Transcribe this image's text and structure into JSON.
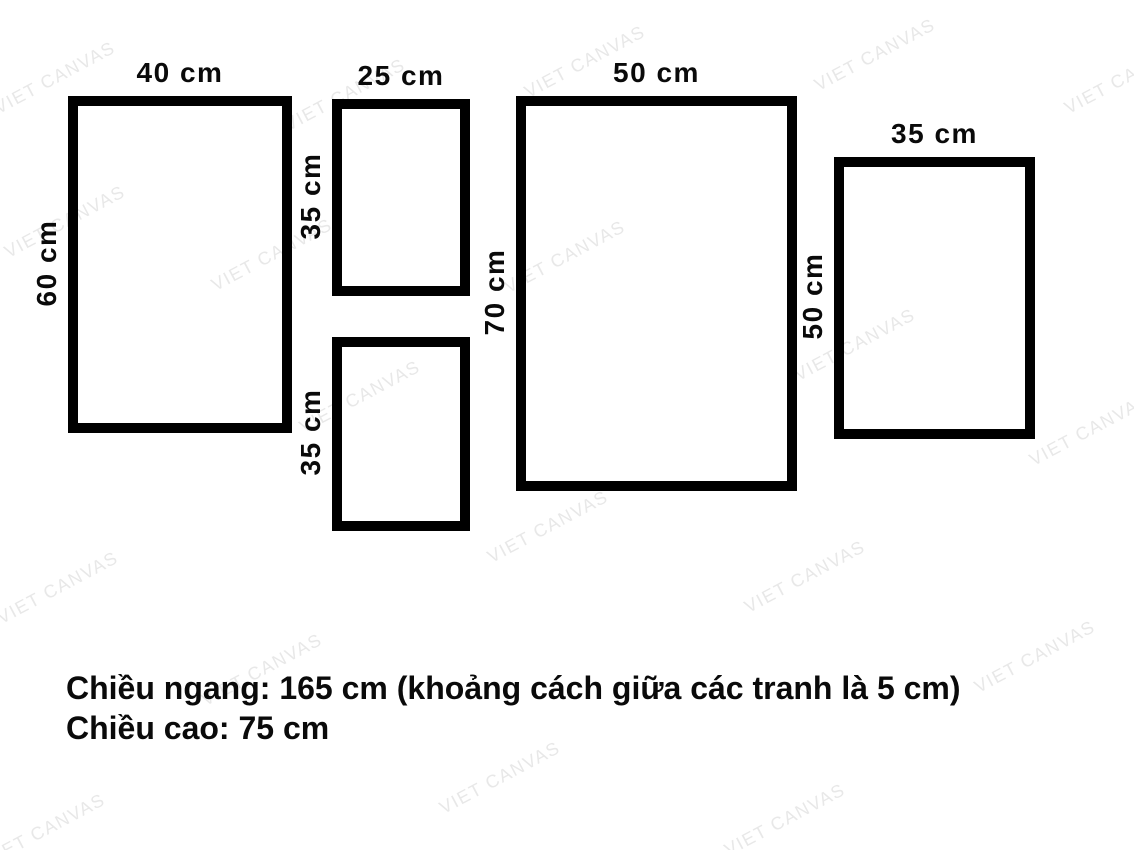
{
  "canvas": {
    "width": 1134,
    "height": 850,
    "background": "#ffffff"
  },
  "colors": {
    "frame_border": "#000000",
    "label_text": "#0a0a0a",
    "watermark": "#e8e8e8"
  },
  "watermark": {
    "text": "VIET CANVAS",
    "angle_deg": -28,
    "positions": [
      [
        55,
        78
      ],
      [
        345,
        95
      ],
      [
        585,
        62
      ],
      [
        875,
        55
      ],
      [
        1125,
        78
      ],
      [
        65,
        222
      ],
      [
        272,
        255
      ],
      [
        565,
        257
      ],
      [
        855,
        345
      ],
      [
        360,
        397
      ],
      [
        1090,
        430
      ],
      [
        548,
        527
      ],
      [
        58,
        588
      ],
      [
        805,
        577
      ],
      [
        262,
        670
      ],
      [
        1035,
        657
      ],
      [
        500,
        778
      ],
      [
        45,
        830
      ],
      [
        785,
        820
      ]
    ]
  },
  "frames": [
    {
      "id": "left-large",
      "x": 68,
      "y": 96,
      "w": 224,
      "h": 337,
      "width_label": "40 cm",
      "height_label": "60 cm"
    },
    {
      "id": "middle-top",
      "x": 332,
      "y": 99,
      "w": 138,
      "h": 197,
      "width_label": "25 cm",
      "height_label": "35 cm"
    },
    {
      "id": "middle-bottom",
      "x": 332,
      "y": 337,
      "w": 138,
      "h": 194,
      "width_label": "",
      "height_label": "35 cm"
    },
    {
      "id": "center-large",
      "x": 516,
      "y": 96,
      "w": 281,
      "h": 395,
      "width_label": "50 cm",
      "height_label": "70 cm"
    },
    {
      "id": "right",
      "x": 834,
      "y": 157,
      "w": 201,
      "h": 282,
      "width_label": "35 cm",
      "height_label": "50 cm"
    }
  ],
  "notes": {
    "line1": "Chiều ngang: 165 cm (khoảng cách giữa các tranh là 5 cm)",
    "line2": "Chiều cao: 75 cm"
  }
}
